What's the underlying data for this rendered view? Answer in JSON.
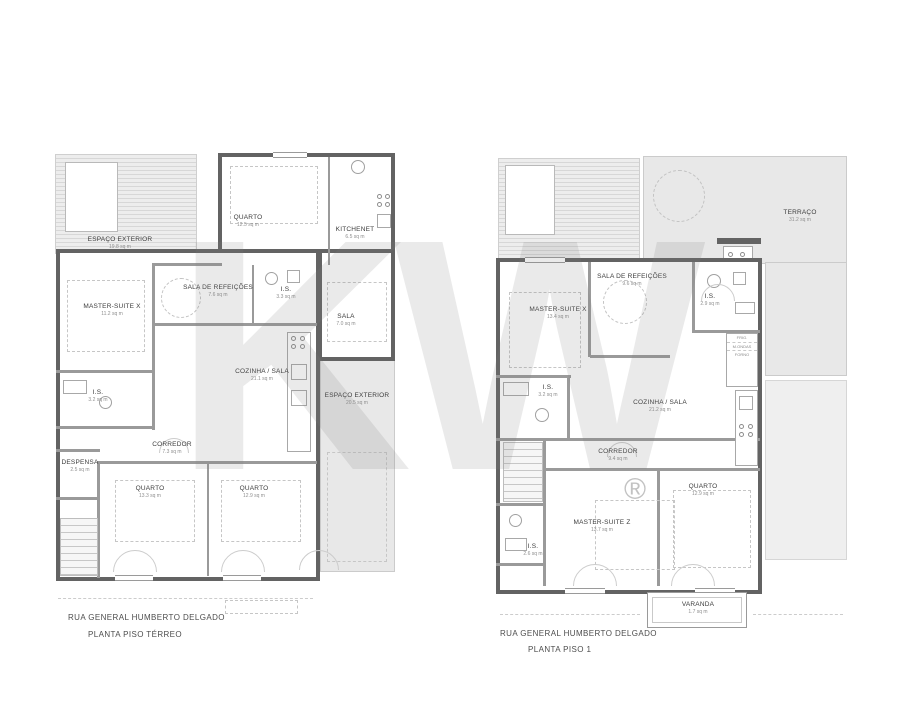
{
  "watermark": {
    "letters": "KW",
    "registered": "®"
  },
  "plans": {
    "ground": {
      "address": "RUA GENERAL HUMBERTO DELGADO",
      "title": "PLANTA PISO TÉRREO",
      "rooms": {
        "espaco_deck": {
          "name": "ESPAÇO EXTERIOR",
          "area": "19.8 sq m"
        },
        "quarto_top": {
          "name": "QUARTO",
          "area": "12.5 sq m"
        },
        "kitchenet": {
          "name": "KITCHENET",
          "area": "6.5 sq m"
        },
        "sala_ref": {
          "name": "SALA DE REFEIÇÕES",
          "area": "7.6 sq m"
        },
        "is_mid": {
          "name": "I.S.",
          "area": "3.3 sq m"
        },
        "master_x": {
          "name": "MASTER-SUITE X",
          "area": "11.2 sq m"
        },
        "sala": {
          "name": "SALA",
          "area": "7.0 sq m"
        },
        "cozinha": {
          "name": "COZINHA / SALA",
          "area": "21.1 sq m"
        },
        "espaco_right": {
          "name": "ESPAÇO EXTERIOR",
          "area": "20.5 sq m"
        },
        "is_left": {
          "name": "I.S.",
          "area": "3.2 sq m"
        },
        "corredor": {
          "name": "CORREDOR",
          "area": "7.3 sq m"
        },
        "despensa": {
          "name": "DESPENSA",
          "area": "2.5 sq m"
        },
        "quarto_bl": {
          "name": "QUARTO",
          "area": "13.3 sq m"
        },
        "quarto_br": {
          "name": "QUARTO",
          "area": "12.9 sq m"
        }
      }
    },
    "first": {
      "address": "RUA GENERAL HUMBERTO DELGADO",
      "title": "PLANTA PISO 1",
      "rooms": {
        "terraco": {
          "name": "TERRAÇO",
          "area": "31.2 sq m"
        },
        "sala_ref": {
          "name": "SALA DE REFEIÇÕES",
          "area": "9.6 sq m"
        },
        "master_x": {
          "name": "MASTER-SUITE X",
          "area": "13.4 sq m"
        },
        "is_top": {
          "name": "I.S.",
          "area": "2.9 sq m"
        },
        "cozinha": {
          "name": "COZINHA / SALA",
          "area": "21.2 sq m"
        },
        "is_mid": {
          "name": "I.S.",
          "area": "3.2 sq m"
        },
        "corredor": {
          "name": "CORREDOR",
          "area": "9.4 sq m"
        },
        "master_z": {
          "name": "MASTER-SUITE Z",
          "area": "13.7 sq m"
        },
        "quarto": {
          "name": "QUARTO",
          "area": "12.9 sq m"
        },
        "is_bottom": {
          "name": "I.S.",
          "area": "2.6 sq m"
        },
        "varanda": {
          "name": "VARANDA",
          "area": "1.7 sq m"
        }
      },
      "appliances": {
        "frig": "FRIG.",
        "micro": "M.ONDAS",
        "forno": "FORNO"
      }
    }
  }
}
